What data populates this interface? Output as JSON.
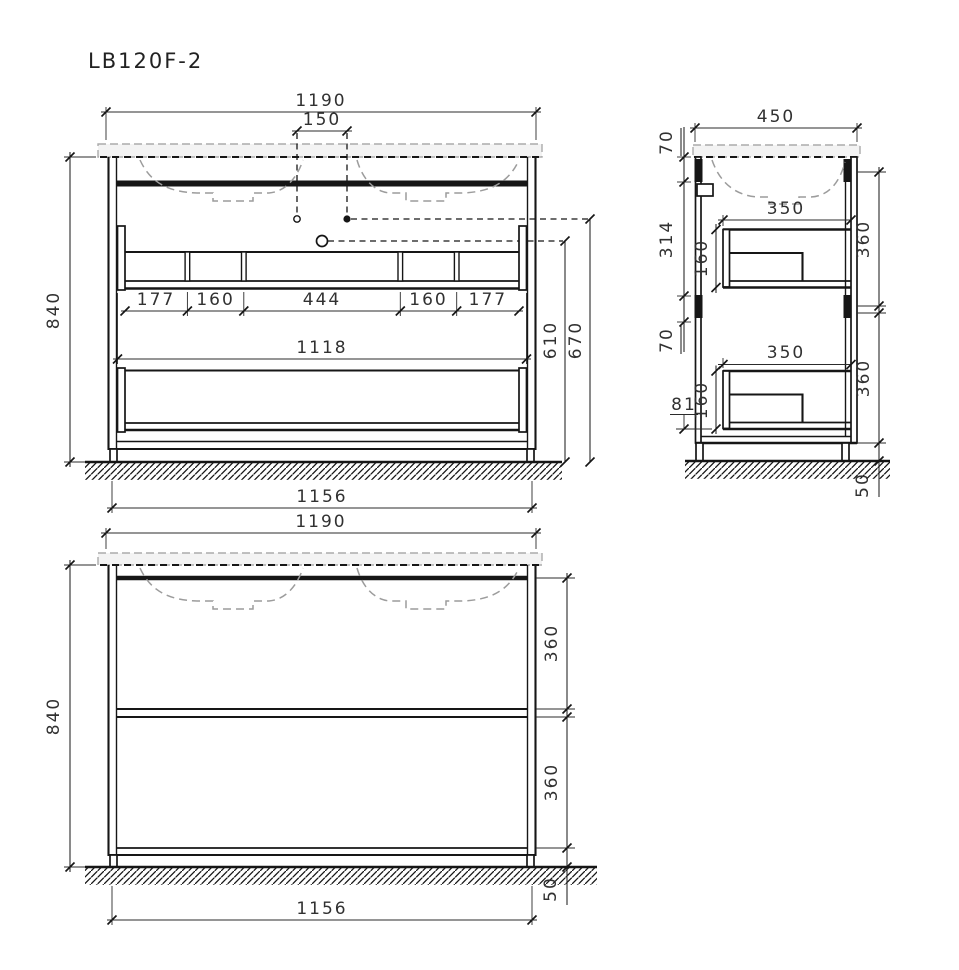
{
  "title": "LB120F-2",
  "views": {
    "front_open": {
      "label": "front view with internal structure",
      "dims": {
        "overall_width": "1190",
        "faucet_hole_spacing": "150",
        "overall_height": "840",
        "shelf_sections": [
          "177",
          "160",
          "444",
          "160",
          "177"
        ],
        "inner_width": "1118",
        "siphon_height": "610",
        "drain_height": "670",
        "base_width": "1156"
      }
    },
    "side": {
      "label": "side section view",
      "dims": {
        "depth": "450",
        "top_bracket_height": "70",
        "bracket_spacing": "314",
        "lower_bracket_height": "70",
        "drawer_depth_upper": "350",
        "drawer_inner_height_upper": "160",
        "drawer_front_height_upper": "360",
        "drawer_depth_lower": "350",
        "drawer_inner_height_lower": "160",
        "drawer_front_height_lower": "360",
        "bottom_clearance": "81",
        "leg_height": "50"
      }
    },
    "front_closed": {
      "label": "front view closed",
      "dims": {
        "overall_width": "1190",
        "overall_height": "840",
        "upper_drawer_front_height": "360",
        "lower_drawer_front_height": "360",
        "base_width": "1156",
        "leg_height": "50"
      }
    }
  }
}
